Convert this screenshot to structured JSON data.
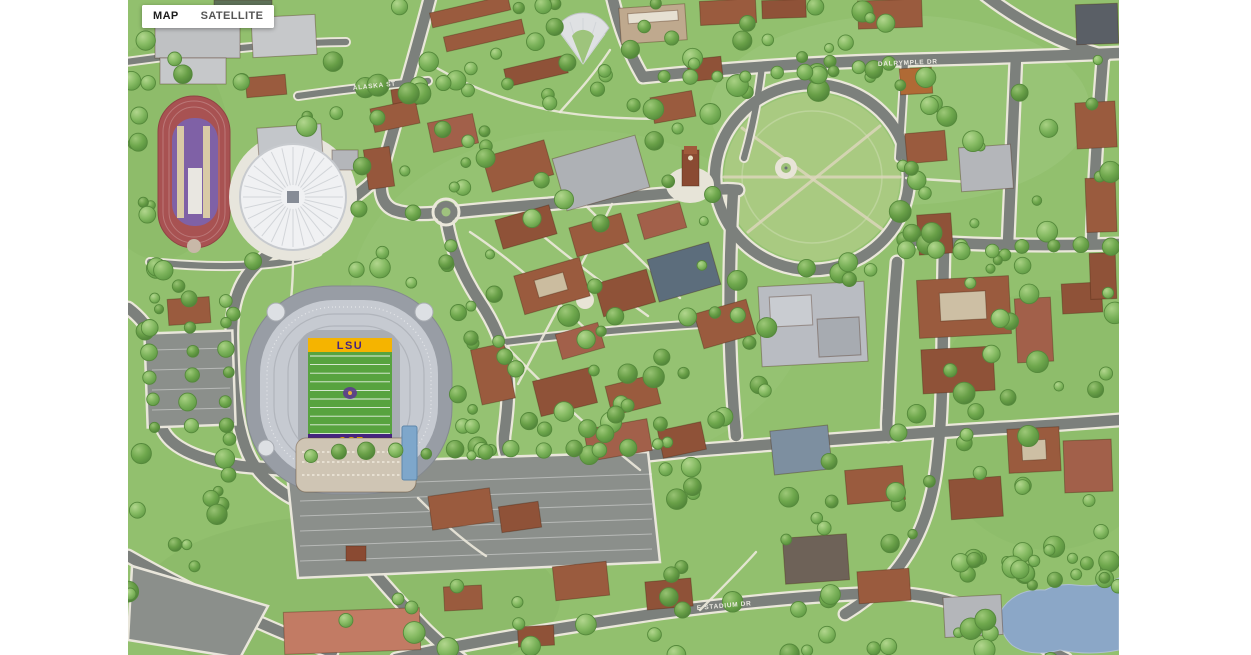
{
  "map_type_control": {
    "map_label": "MAP",
    "satellite_label": "SATELLITE",
    "active": "MAP"
  },
  "street_labels": [
    {
      "text": "ALASKA ST"
    },
    {
      "text": "DALRYMPLE DR"
    },
    {
      "text": "E STADIUM DR"
    }
  ],
  "stadium": {
    "end_zone_north_text": "LSU",
    "end_zone_south_text": "LSU"
  },
  "colors": {
    "grass": "#92c06e",
    "road": "#7c807c",
    "water": "#8ba7c7",
    "parade_lawn": "#a9ca81",
    "field_green": "#57a33f",
    "lsu_gold": "#f5b400",
    "lsu_purple": "#46247e",
    "track_red": "#a85252",
    "track_infield_purple": "#7f61a6",
    "roof_brown": "#9a5b3e"
  }
}
